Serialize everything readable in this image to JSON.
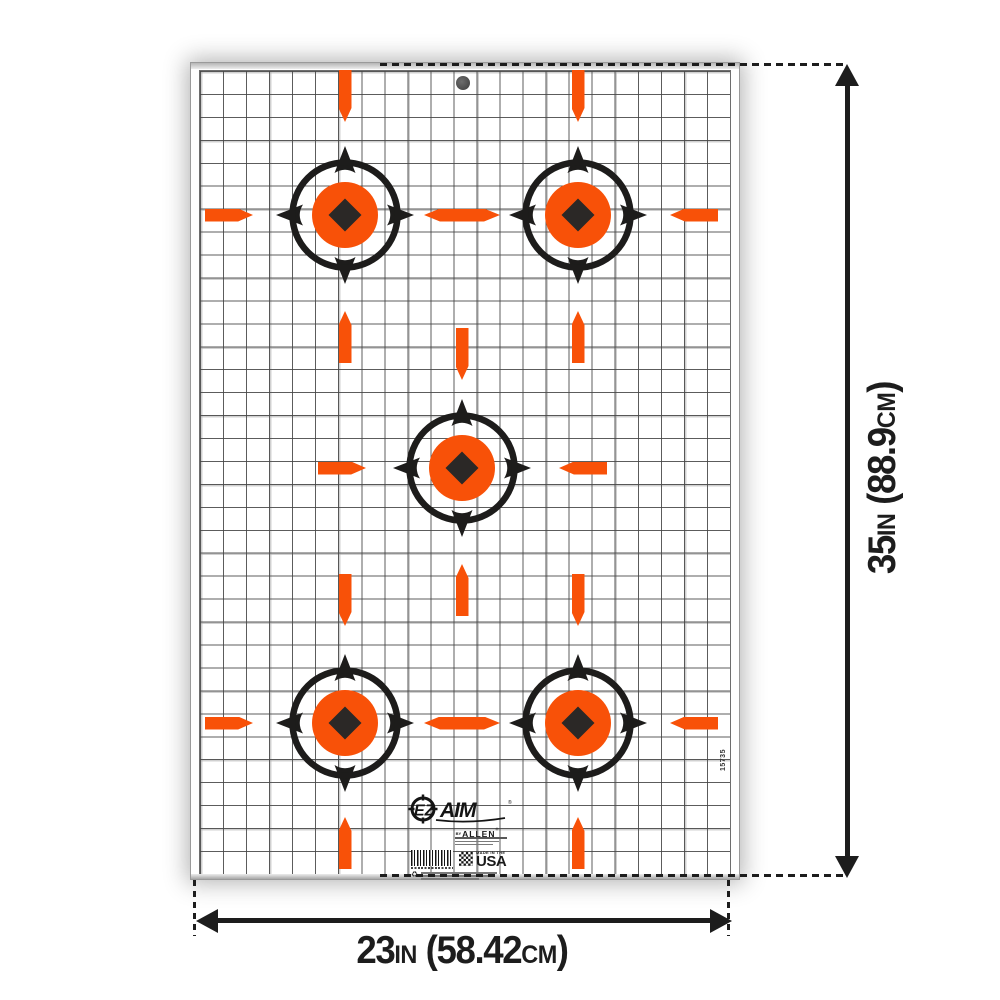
{
  "colors": {
    "orange": "#F85108",
    "ink": "#1D1C1B",
    "diamond": "#2B2826",
    "dim_line": "#1D1D1D"
  },
  "brand": {
    "ez": "EZ",
    "aim": "AIM",
    "reg": "®",
    "by": "BY",
    "allen": "ALLEN",
    "allen_reg": "®"
  },
  "made_in": {
    "line1": "MADE IN THE",
    "line2": "USA"
  },
  "sku_vertical": "15735",
  "dimension_labels": {
    "height": {
      "text": "35IN (88.9CM)",
      "parts": [
        {
          "t": "35"
        },
        {
          "t": "IN",
          "small": true
        },
        {
          "t": " ("
        },
        {
          "t": "88.9"
        },
        {
          "t": "CM",
          "small": true
        },
        {
          "t": ")"
        }
      ]
    },
    "width": {
      "text": "23IN (58.42CM)",
      "parts": [
        {
          "t": "23"
        },
        {
          "t": "IN",
          "small": true
        },
        {
          "t": " ("
        },
        {
          "t": "58.42"
        },
        {
          "t": "CM",
          "small": true
        },
        {
          "t": ")"
        }
      ]
    }
  },
  "targets": [
    {
      "x": 345,
      "y": 215
    },
    {
      "x": 578,
      "y": 215
    },
    {
      "x": 462,
      "y": 468
    },
    {
      "x": 345,
      "y": 723
    },
    {
      "x": 578,
      "y": 723
    }
  ],
  "ticks": [
    {
      "l": 338.5,
      "t": 70,
      "w": 13,
      "h": 52,
      "dir": "down"
    },
    {
      "l": 571.5,
      "t": 70,
      "w": 13,
      "h": 52,
      "dir": "down"
    },
    {
      "l": 338.5,
      "t": 311,
      "w": 13,
      "h": 52,
      "dir": "up"
    },
    {
      "l": 455.5,
      "t": 328,
      "w": 13,
      "h": 52,
      "dir": "down"
    },
    {
      "l": 571.5,
      "t": 311,
      "w": 13,
      "h": 52,
      "dir": "up"
    },
    {
      "l": 338.5,
      "t": 574,
      "w": 13,
      "h": 52,
      "dir": "down"
    },
    {
      "l": 455.5,
      "t": 564,
      "w": 13,
      "h": 52,
      "dir": "up"
    },
    {
      "l": 571.5,
      "t": 574,
      "w": 13,
      "h": 52,
      "dir": "down"
    },
    {
      "l": 338.5,
      "t": 817,
      "w": 13,
      "h": 52,
      "dir": "up"
    },
    {
      "l": 571.5,
      "t": 817,
      "w": 13,
      "h": 52,
      "dir": "up"
    },
    {
      "l": 205,
      "t": 208.5,
      "w": 48,
      "h": 13,
      "dir": "right"
    },
    {
      "l": 424,
      "t": 208.5,
      "w": 76,
      "h": 13,
      "dir": "double"
    },
    {
      "l": 670,
      "t": 208.5,
      "w": 48,
      "h": 13,
      "dir": "left"
    },
    {
      "l": 318,
      "t": 461.5,
      "w": 48,
      "h": 13,
      "dir": "right"
    },
    {
      "l": 559,
      "t": 461.5,
      "w": 48,
      "h": 13,
      "dir": "left"
    },
    {
      "l": 205,
      "t": 716.5,
      "w": 48,
      "h": 13,
      "dir": "right"
    },
    {
      "l": 424,
      "t": 716.5,
      "w": 76,
      "h": 13,
      "dir": "double"
    },
    {
      "l": 670,
      "t": 716.5,
      "w": 48,
      "h": 13,
      "dir": "left"
    }
  ]
}
